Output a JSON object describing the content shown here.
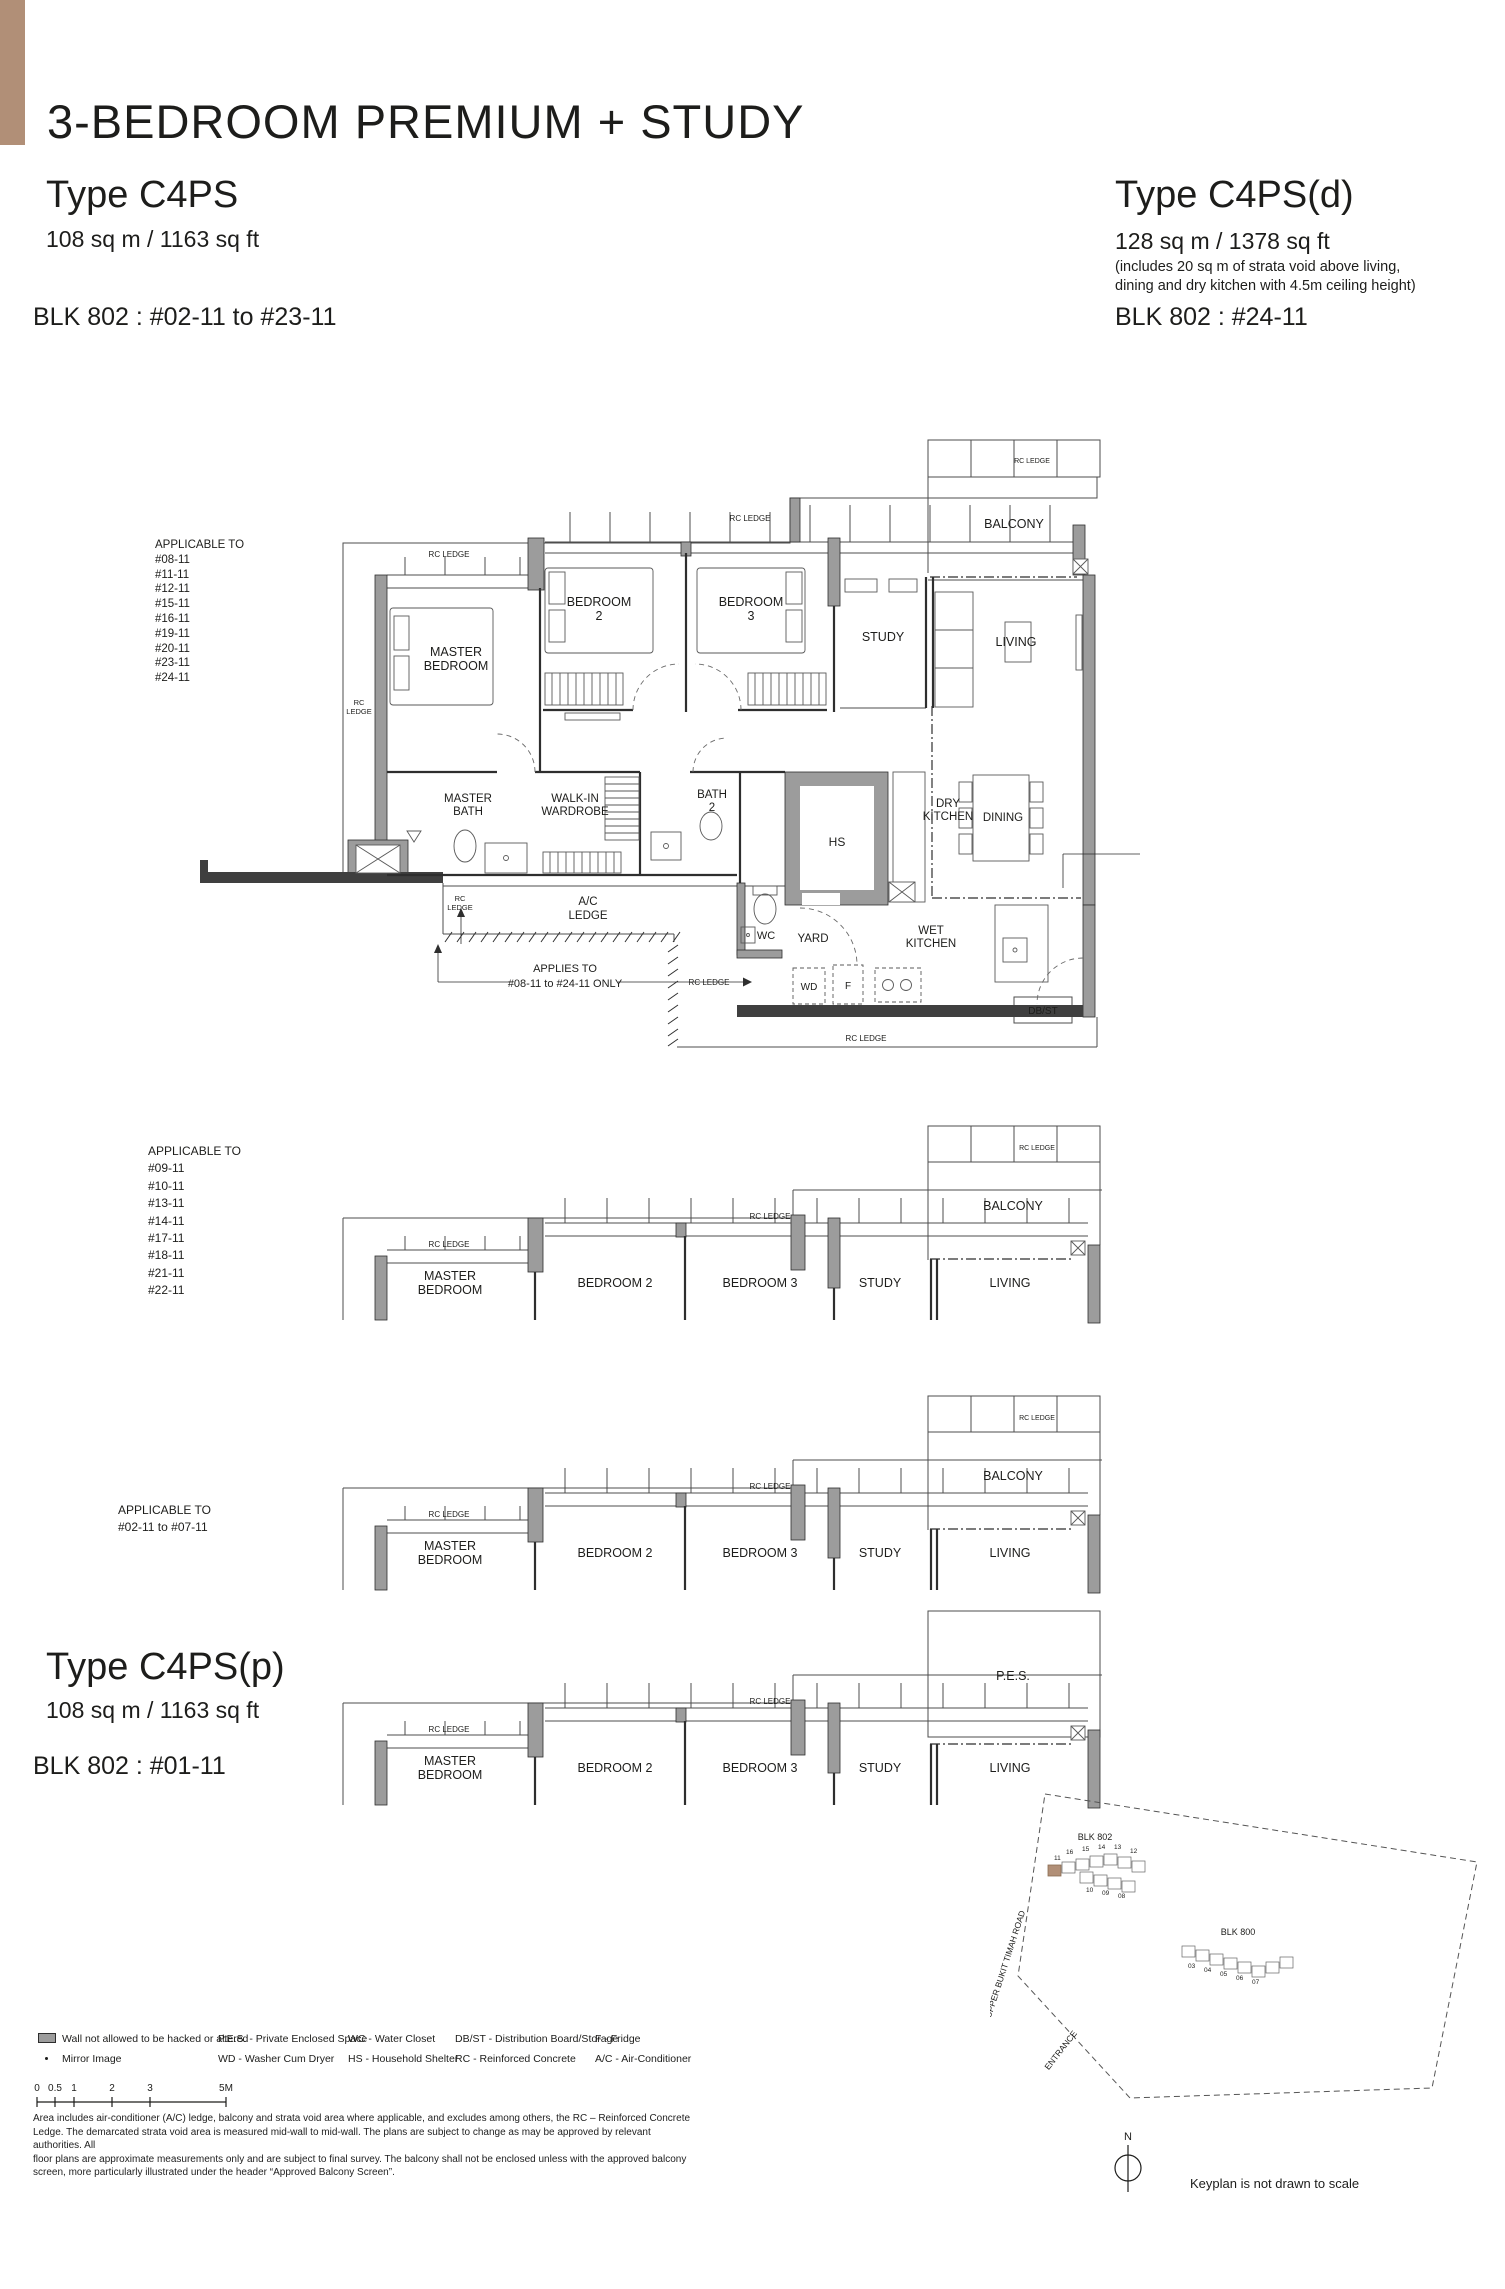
{
  "colors": {
    "accent": "#b18f77",
    "wall_gray": "#9c9c9c"
  },
  "header": {
    "title": "3-BEDROOM PREMIUM + STUDY"
  },
  "types": {
    "c4ps": {
      "name": "Type C4PS",
      "area": "108 sq m / 1163 sq ft",
      "block": "BLK 802 : #02-11 to #23-11"
    },
    "c4psd": {
      "name": "Type C4PS(d)",
      "area": "128 sq m / 1378 sq ft",
      "note1": "(includes 20 sq m of strata void above living,",
      "note2": "dining and dry kitchen with 4.5m ceiling height)",
      "block": "BLK 802 : #24-11"
    },
    "c4psp": {
      "name": "Type C4PS(p)",
      "area": "108 sq m / 1163 sq ft",
      "block": "BLK 802 : #01-11"
    }
  },
  "labels": {
    "master": "MASTER",
    "bedroom": "BEDROOM",
    "two": "2",
    "three": "3",
    "bedroom2": "BEDROOM 2",
    "bedroom3": "BEDROOM 3",
    "study": "STUDY",
    "living": "LIVING",
    "balcony": "BALCONY",
    "pes": "P.E.S.",
    "bath": "BATH",
    "walkin": "WALK-IN",
    "wardrobe": "WARDROBE",
    "hs": "HS",
    "dry": "DRY",
    "kitchen": "KITCHEN",
    "dining": "DINING",
    "ac": "A/C",
    "ledge": "LEDGE",
    "rc": "RC",
    "rcledge": "RC LEDGE",
    "wc": "WC",
    "yard": "YARD",
    "wet": "WET",
    "wd": "WD",
    "f": "F",
    "dbst": "DB/ST"
  },
  "plan_a": {
    "applicable_title": "APPLICABLE TO",
    "units": [
      "#08-11",
      "#11-11",
      "#12-11",
      "#15-11",
      "#16-11",
      "#19-11",
      "#20-11",
      "#23-11",
      "#24-11"
    ],
    "applies1": "APPLIES TO",
    "applies2": "#08-11 to #24-11 ONLY",
    "note1": "DENOTES 4.5M CEILING HEIGHT ABOVE",
    "note2": "LIVING, DINING AND DRY KITCHEN",
    "note3": "WITH STRATA VOID OF 20 SQ M"
  },
  "plan_b": {
    "applicable_title": "APPLICABLE TO",
    "units": [
      "#09-11",
      "#10-11",
      "#13-11",
      "#14-11",
      "#17-11",
      "#18-11",
      "#21-11",
      "#22-11"
    ]
  },
  "plan_c": {
    "applicable_title": "APPLICABLE TO",
    "range": "#02-11 to #07-11"
  },
  "legend": {
    "wall": "Wall not allowed to be hacked or altered",
    "mirror": "Mirror Image",
    "pes": "P.E.S. - Private Enclosed Space",
    "wd": "WD - Washer Cum Dryer",
    "wc": "WC - Water Closet",
    "hs": "HS - Household Shelter",
    "dbst": "DB/ST - Distribution Board/Storage",
    "rc": "RC - Reinforced Concrete",
    "f": "F - Fridge",
    "ac": "A/C - Air-Conditioner"
  },
  "scalebar": {
    "t0": "0",
    "t05": "0.5",
    "t1": "1",
    "t2": "2",
    "t3": "3",
    "t5": "5M"
  },
  "disclaimer": {
    "l1": "Area includes air-conditioner (A/C) ledge, balcony and strata void area where applicable, and excludes among others, the RC – Reinforced Concrete",
    "l2": "Ledge. The demarcated strata void area is measured mid-wall to mid-wall. The plans are subject to change as may be approved by relevant authorities. All",
    "l3": "floor plans are approximate measurements only and are subject to final survey. The balcony shall not be enclosed unless with the approved balcony",
    "l4": "screen, more particularly illustrated under the header “Approved Balcony Screen”."
  },
  "keyplan": {
    "blk802": "BLK 802",
    "blk800": "BLK 800",
    "road": "UPPER BUKIT TIMAH ROAD",
    "entrance": "ENTRANCE",
    "north": "N",
    "note": "Keyplan is not drawn to scale",
    "u16": "16",
    "u15": "15",
    "u14": "14",
    "u13": "13",
    "u12": "12",
    "u11": "11",
    "u10": "10",
    "u09": "09",
    "u08": "08",
    "u03": "03",
    "u04": "04",
    "u05": "05",
    "u06": "06",
    "u07": "07"
  }
}
